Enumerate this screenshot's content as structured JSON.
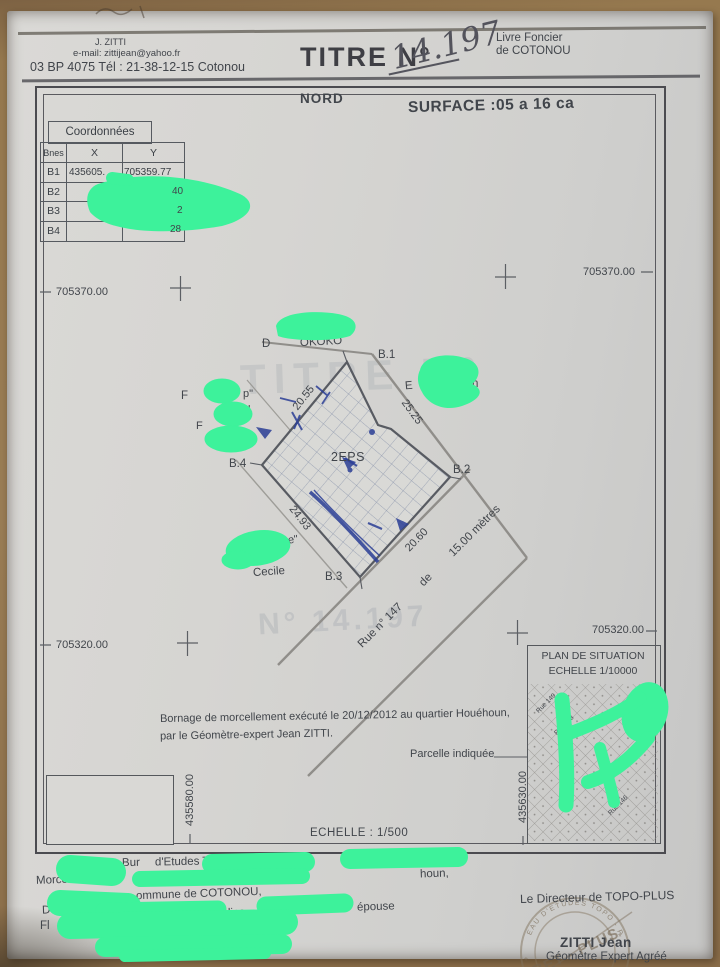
{
  "header": {
    "surveyor_line1": "J. ZITTI",
    "surveyor_line2": "e-mail: zittijean@yahoo.fr",
    "surveyor_line3": "03 BP 4075 Tél : 21-38-12-15 Cotonou",
    "title_label": "TITRE N°",
    "title_number": "14.197",
    "registry_line1": "Livre Foncier",
    "registry_line2": "de COTONOU"
  },
  "map": {
    "north_label": "NORD",
    "surface_label": "SURFACE :05 a 16 ca",
    "scale_label": "ECHELLE : 1/500",
    "grid_labels": {
      "top_left": "705370.00",
      "top_right": "705370.00",
      "bottom_left": "705320.00",
      "bottom_right": "705320.00",
      "vertical_left": "435580.00",
      "vertical_right": "435630.00"
    },
    "table": {
      "title": "Coordonnées",
      "col_bnes": "Bnes",
      "col_x": "X",
      "col_y": "Y",
      "rows": [
        {
          "bne": "B1",
          "x": "435605.",
          "y": "705359.77"
        },
        {
          "bne": "B2",
          "x": "",
          "y": "40"
        },
        {
          "bne": "B3",
          "x": "",
          "y": "2"
        },
        {
          "bne": "B4",
          "x": "",
          "y": "28"
        }
      ]
    },
    "parcel": {
      "label": "2EPS",
      "corner1": "B.1",
      "corner2": "B.2",
      "corner3": "B.3",
      "corner4": "B.4",
      "dim_nw": "20.55",
      "dim_ne": "25.25",
      "dim_sw": "24.93",
      "dim_se": "20.60"
    },
    "street": {
      "name": "Rue n° 147",
      "middle": "de",
      "width": "15.00 mètres"
    },
    "neighbors": {
      "north_a": "D",
      "north_b": "OKOKO",
      "east_a": "E",
      "east_b": "n",
      "east_c": "SHIEL",
      "west_a": "F",
      "west_b": "p\"",
      "west_c": "l",
      "west_d": "F",
      "south_a": "e\"",
      "south_b": "Cecile"
    },
    "note_line1": "Bornage de morcellement exécuté le 20/12/2012 au quartier Houéhoun,",
    "note_line2": "par le Géomètre-expert Jean ZITTI.",
    "parcelle_indiquee": "Parcelle indiquée",
    "situation": {
      "title1": "PLAN DE SITUATION",
      "title2": "ECHELLE 1/10000",
      "street1": "Rue 149",
      "street2": "Rue 148",
      "street3": "Rue 146"
    },
    "watermark1": "TITRE N°",
    "watermark2": "N° 14.197"
  },
  "footer": {
    "frag_line1a": "Bur",
    "frag_line1b": "d'Etudes T",
    "frag_line1c": "houn,",
    "frag_line2": "Morcellem",
    "frag_line3": "ommune de COTONOU,",
    "frag_line4a": "Deman",
    "frag_line4b": "lice",
    "frag_line4c": "épouse",
    "frag_line5": "Fl",
    "director_label": "Le Directeur de TOPO-PLUS",
    "signer_name": "ZITTI Jean",
    "signer_title": "Géomètre Expert Agréé",
    "stamp_arc": "BUREAU D'ETUDES TOPO - PLUS",
    "stamp_center": "BET - PLUS"
  }
}
